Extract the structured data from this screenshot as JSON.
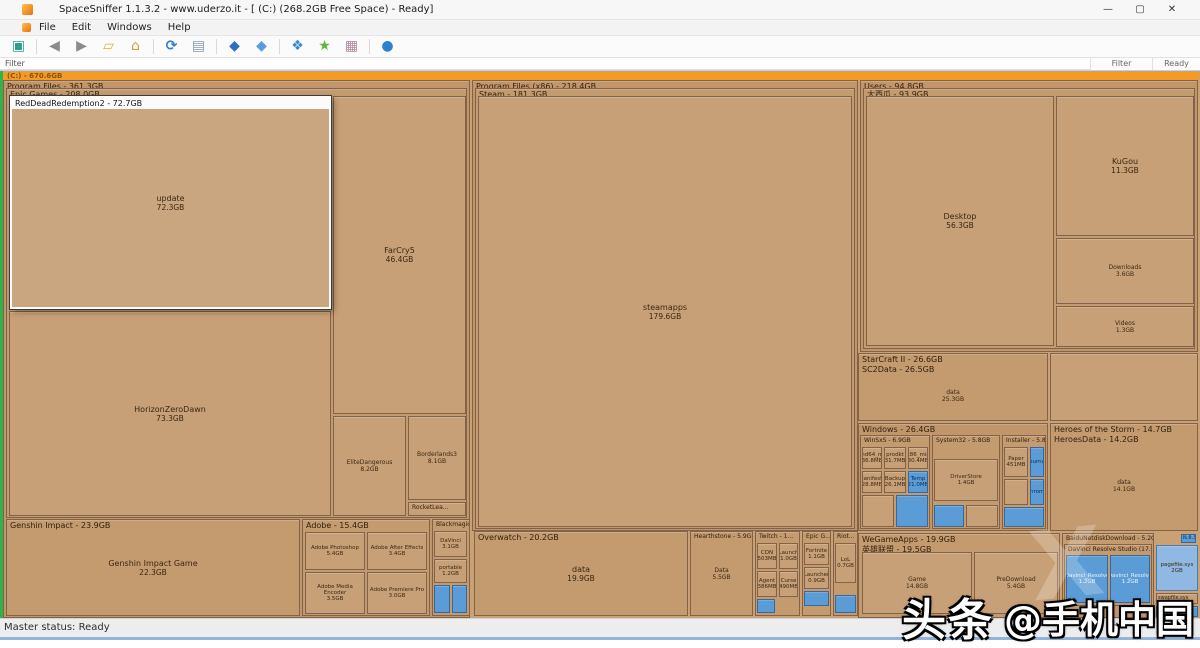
{
  "window": {
    "title": "SpaceSniffer 1.1.3.2 - www.uderzo.it - [ (C:) (268.2GB Free Space) - Ready]",
    "controls": {
      "minimize": "—",
      "maximize": "▢",
      "close": "✕"
    },
    "menu": {
      "items": [
        {
          "label": "File"
        },
        {
          "label": "Edit"
        },
        {
          "label": "Windows"
        },
        {
          "label": "Help"
        }
      ]
    }
  },
  "toolbar": {
    "buttons": [
      {
        "name": "new-view",
        "glyph": "▣",
        "color": "#2f9e8e"
      },
      {
        "name": "nav-back",
        "glyph": "◀",
        "color": "#8c8c8c"
      },
      {
        "name": "nav-forward",
        "glyph": "▶",
        "color": "#8c8c8c"
      },
      {
        "name": "open-folder",
        "glyph": "▱",
        "color": "#d8b12f"
      },
      {
        "name": "export",
        "glyph": "⌂",
        "color": "#c9a23a"
      },
      {
        "name": "refresh",
        "glyph": "⟳",
        "color": "#2f7fd0"
      },
      {
        "name": "rescan-document",
        "glyph": "▤",
        "color": "#8a9bb0"
      },
      {
        "name": "filter-cube",
        "glyph": "◆",
        "color": "#2f6fc0"
      },
      {
        "name": "filter-cube-2",
        "glyph": "◆",
        "color": "#5b9be0"
      },
      {
        "name": "class-cubes",
        "glyph": "❖",
        "color": "#3a87d0"
      },
      {
        "name": "star-tag",
        "glyph": "★",
        "color": "#63b53a"
      },
      {
        "name": "media-cards",
        "glyph": "▦",
        "color": "#b08aa0"
      },
      {
        "name": "about-sphere",
        "glyph": "●",
        "color": "#2f7fd0"
      }
    ]
  },
  "filterbar": {
    "filter_label": "Filter",
    "filter_panel": "Filter",
    "ready_panel": "Ready"
  },
  "statusbar": {
    "text": "Master status: Ready"
  },
  "watermark": {
    "brand": "头条",
    "handle": "@手机中国",
    "ghost": "X"
  },
  "treemap": {
    "drive_label": "(C:) - 670.6GB",
    "program_files": {
      "label": "Program Files - 361.3GB"
    },
    "epic_games": {
      "label": "Epic Games - 208.0GB"
    },
    "rdr2": {
      "label": "RedDeadRedemption2 - 72.7GB",
      "name": "update",
      "size": "72.3GB"
    },
    "horizon": {
      "name": "HorizonZeroDawn",
      "size": "73.3GB"
    },
    "farcry": {
      "name": "FarCry5",
      "size": "46.4GB"
    },
    "elite": {
      "name": "EliteDangerous",
      "size": "8.2GB"
    },
    "borderlands": {
      "name": "Borderlands3",
      "size": "8.1GB"
    },
    "rocket": {
      "label": "RocketLea..."
    },
    "genshin": {
      "label": "Genshin Impact - 23.9GB",
      "name": "Genshin Impact Game",
      "size": "22.3GB"
    },
    "adobe": {
      "label": "Adobe - 15.4GB",
      "cells": [
        {
          "name": "Adobe Photoshop",
          "size": "5.4GB"
        },
        {
          "name": "Adobe After Effects",
          "size": "3.4GB"
        },
        {
          "name": "Adobe Media Encoder",
          "size": "3.5GB"
        },
        {
          "name": "Adobe Premiere Pro",
          "size": "3.0GB"
        }
      ]
    },
    "blackmagic": {
      "label": "Blackmagic De...",
      "cells": [
        {
          "name": "DaVinci",
          "size": "3.1GB"
        },
        {
          "name": "portable",
          "size": "1.2GB"
        }
      ]
    },
    "pfx86": {
      "label": "Program Files (x86) - 218.4GB"
    },
    "steam": {
      "label": "Steam - 181.3GB"
    },
    "steamapps": {
      "name": "steamapps",
      "size": "179.6GB"
    },
    "overwatch": {
      "label": "Overwatch - 20.2GB",
      "name": "data",
      "size": "19.9GB"
    },
    "hearthstone": {
      "label": "Hearthstone - 5.9GB",
      "name": "Data",
      "size": "5.5GB"
    },
    "twitch": {
      "label": "Twitch - 1...",
      "cells": [
        {
          "name": "CDN",
          "size": "503MB"
        },
        {
          "name": "Launch",
          "size": "1.0GB"
        },
        {
          "name": "Agent",
          "size": "386MB"
        },
        {
          "name": "Curse",
          "size": "490MB"
        }
      ]
    },
    "epic_small": {
      "label": "Epic G...",
      "cells": [
        {
          "name": "Fortnite",
          "size": "1.1GB"
        },
        {
          "name": "Launcher",
          "size": "0.9GB"
        }
      ]
    },
    "riot": {
      "label": "Riot...",
      "cells": [
        {
          "name": "LoL",
          "size": "0.7GB"
        }
      ]
    },
    "users": {
      "label": "Users - 94.8GB"
    },
    "user_folder": {
      "label": "大西瓜 - 93.9GB"
    },
    "desktop": {
      "name": "Desktop",
      "size": "56.3GB"
    },
    "kugou": {
      "name": "KuGou",
      "size": "11.3GB"
    },
    "downloads": {
      "name": "Downloads",
      "size": "3.6GB"
    },
    "videos": {
      "name": "Videos",
      "size": "1.3GB"
    },
    "starcraft": {
      "label": "StarCraft II - 26.6GB",
      "sublabel": "SC2Data - 26.5GB",
      "name": "data",
      "size": "25.3GB"
    },
    "windows": {
      "label": "Windows - 26.4GB"
    },
    "winsxs": {
      "label": "WinSxS - 6.9GB",
      "cells": [
        {
          "name": "amd64_mic",
          "size": "36.8MB"
        },
        {
          "name": "prodkt",
          "size": "31.7MB"
        },
        {
          "name": "x86_mic",
          "size": "30.4MB"
        },
        {
          "name": "Manifests",
          "size": "28.8MB"
        },
        {
          "name": "Backup",
          "size": "26.1MB"
        },
        {
          "name": "Temp",
          "size": "21.0MB"
        }
      ]
    },
    "system32": {
      "label": "System32 - 5.8GB",
      "name": "DriverStore",
      "size": "1.4GB"
    },
    "installer": {
      "label": "Installer - 5.8GB",
      "cells": [
        {
          "name": "Paper",
          "size": "451MB"
        },
        {
          "name": "Journal",
          "size": "1.1GB"
        },
        {
          "name": "Chrome",
          "size": "1.0GB"
        }
      ]
    },
    "heroes": {
      "label": "Heroes of the Storm - 14.7GB",
      "sublabel": "HeroesData - 14.2GB",
      "name": "data",
      "size": "14.1GB"
    },
    "wegame": {
      "label": "WeGameApps - 19.9GB",
      "sublabel": "英雄联盟 - 19.5GB",
      "name": "Game",
      "size": "14.8GB",
      "pre_name": "PreDownload",
      "pre_size": "5.4GB"
    },
    "baidu": {
      "label": "BaiduNetdiskDownload - 5.2GB"
    },
    "davinci": {
      "label": "DaVinci Resolve Studio (17.4...",
      "cells": [
        {
          "name": "Davinci_Resolve",
          "size": "1.2GB"
        },
        {
          "name": "Davinci_Resolve",
          "size": "1.2GB"
        }
      ]
    },
    "pagefile": {
      "name": "pagefile.sys",
      "size": "2GB"
    },
    "tiny": {
      "a": "N.8.3.2",
      "b": "swapfile.sys",
      "c": "M.8.3.2"
    }
  }
}
